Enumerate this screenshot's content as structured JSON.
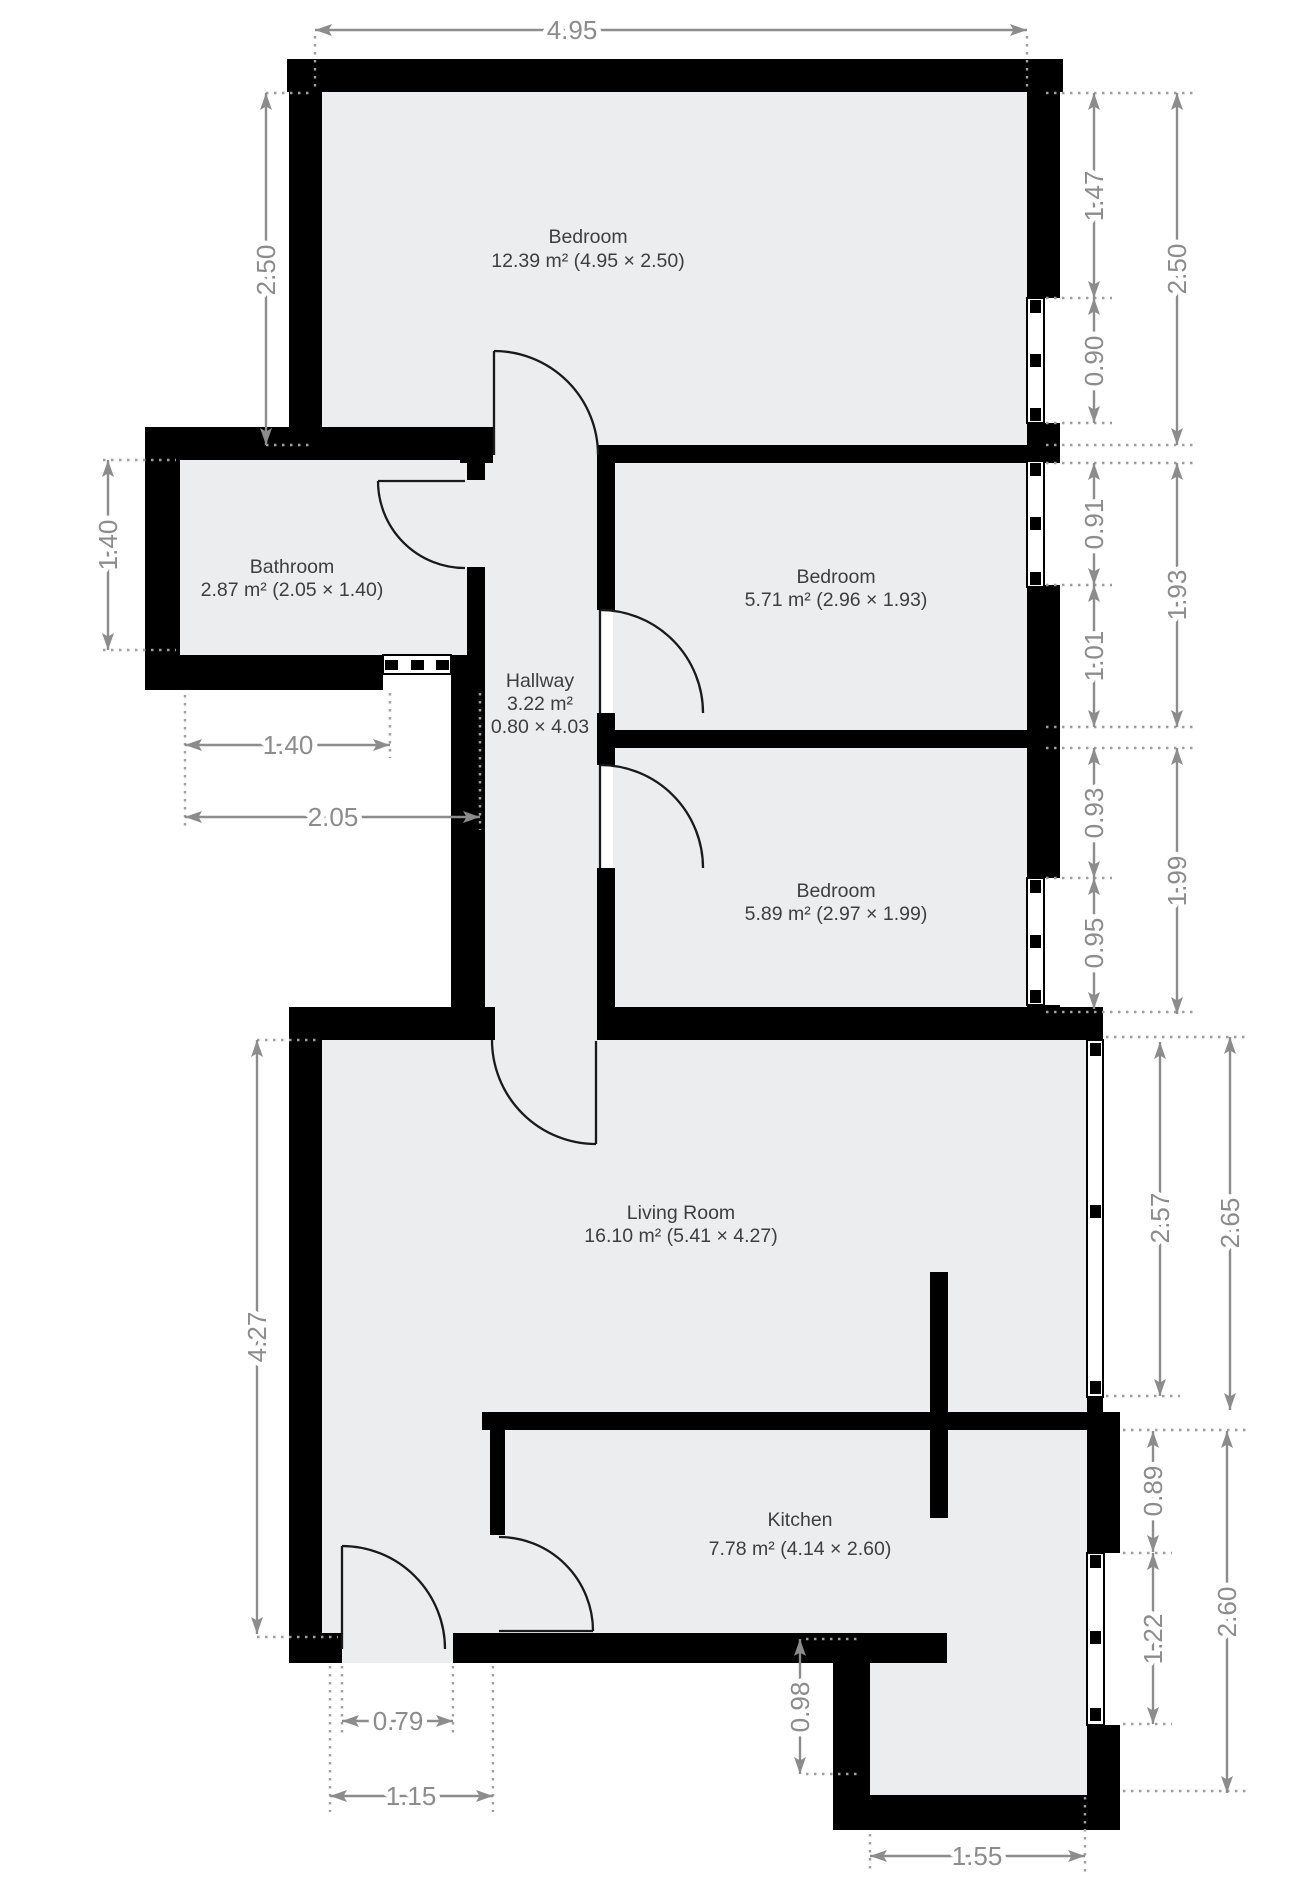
{
  "plan_title": "Apartment floor plan",
  "units": "m",
  "rooms": {
    "bedroom_top": {
      "name": "Bedroom",
      "area": "12.39 m² (4.95 × 2.50)"
    },
    "bedroom_mid": {
      "name": "Bedroom",
      "area": "5.71 m² (2.96 × 1.93)"
    },
    "bedroom_small": {
      "name": "Bedroom",
      "area": "5.89 m² (2.97 × 1.99)"
    },
    "bathroom": {
      "name": "Bathroom",
      "area": "2.87 m² (2.05 × 1.40)"
    },
    "hallway": {
      "name": "Hallway",
      "area": "3.22 m²",
      "dims": "0.80 × 4.03"
    },
    "living": {
      "name": "Living Room",
      "area": "16.10 m² (5.41 × 4.27)"
    },
    "kitchen": {
      "name": "Kitchen",
      "area": "7.78 m² (4.14 × 2.60)"
    }
  },
  "dimensions": {
    "top_width": "4.95",
    "bed1_left_height": "2.50",
    "bed1_right_upper": "1.47",
    "bed1_right_window": "0.90",
    "bed1_right_total": "2.50",
    "bath_left_height": "1.40",
    "bath_bottom_wall": "1.40",
    "bath_bottom_total": "2.05",
    "bed2_right_window": "0.91",
    "bed2_right_lower": "1.01",
    "bed2_right_total": "1.93",
    "bed3_right_upper": "0.93",
    "bed3_right_window": "0.95",
    "bed3_right_total": "1.99",
    "living_left_height": "4.27",
    "living_right_window": "2.57",
    "living_right_total": "2.65",
    "kitchen_right_upper": "0.89",
    "kitchen_right_window": "1.22",
    "kitchen_right_total": "2.60",
    "entry_door_width": "0.79",
    "entry_total_width": "1.15",
    "kitchen_step_height": "0.98",
    "kitchen_ext_width": "1.55"
  },
  "colors": {
    "wall": "#000000",
    "floor": "#ebedee",
    "dimension": "#8c8c8c",
    "room_text": "#3e3e3e",
    "background": "#ffffff"
  }
}
